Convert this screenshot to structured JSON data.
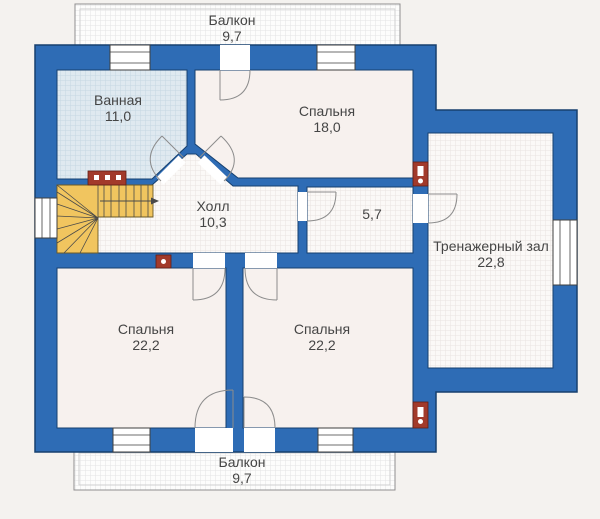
{
  "title": "Floor plan — second storey",
  "colors": {
    "wall": "#2e6cb5",
    "wall_outline": "#16406f",
    "room": "#f7f1ee",
    "grid_room": "#fbf9f7",
    "grid_line": "#eae4e0",
    "bath": "#dfe9f0",
    "bath_line": "#c6d6e2",
    "stairs": "#f1c55f",
    "chimney": "#a23a2b",
    "door": "#8c8c8c",
    "window": "#3f3f3f",
    "label": "#454545",
    "bg": "#f4f2ef"
  },
  "rooms": [
    {
      "id": "balcony-top",
      "name": "Балкон",
      "area": "9,7"
    },
    {
      "id": "bathroom",
      "name": "Ванная",
      "area": "11,0"
    },
    {
      "id": "bedroom-top",
      "name": "Спальня",
      "area": "18,0"
    },
    {
      "id": "hall",
      "name": "Холл",
      "area": "10,3"
    },
    {
      "id": "small-room",
      "area": "5,7"
    },
    {
      "id": "gym",
      "name": "Тренажерный зал",
      "area": "22,8"
    },
    {
      "id": "bedroom-left",
      "name": "Спальня",
      "area": "22,2"
    },
    {
      "id": "bedroom-right",
      "name": "Спальня",
      "area": "22,2"
    },
    {
      "id": "balcony-bottom",
      "name": "Балкон",
      "area": "9,7"
    }
  ]
}
